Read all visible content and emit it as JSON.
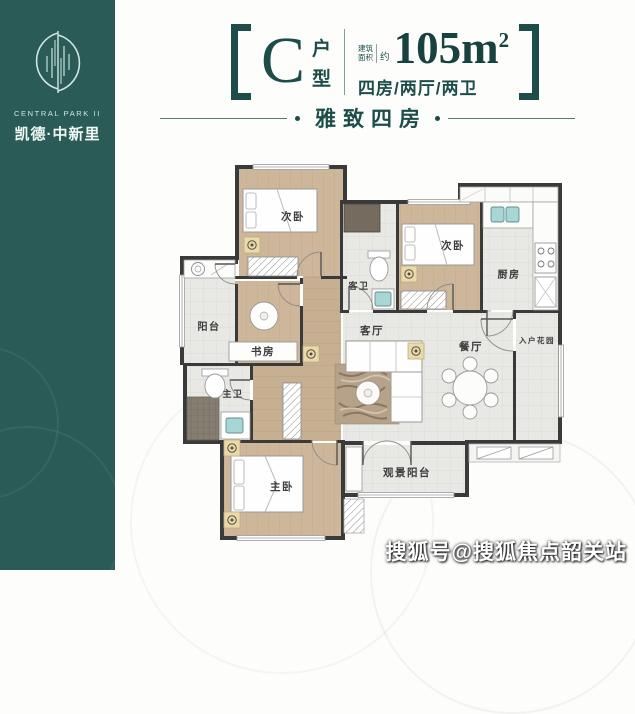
{
  "brand": {
    "name_en": "CENTRAL PARK II",
    "name_cn": "凯德·中新里"
  },
  "header": {
    "type_letter": "C",
    "type_chars": [
      "户",
      "型"
    ],
    "area_prefix_top": "建筑",
    "area_prefix_bottom": "面积",
    "area_approx": "约",
    "area_value": "105m",
    "area_sup": "2",
    "layout_desc": "四房/两厅/两卫",
    "subtitle": "雅致四房"
  },
  "floorplan": {
    "rooms": {
      "bedroom_top_left": "次卧",
      "bedroom_top_right": "次卧",
      "kitchen": "厨房",
      "guest_bath": "客卫",
      "balcony": "阳台",
      "study": "书房",
      "living": "客厅",
      "dining": "餐厅",
      "entry_garden": "入户花园",
      "master_bath": "主卫",
      "master_bedroom": "主卧",
      "view_balcony": "观景阳台"
    }
  },
  "watermark": "搜狐号@搜狐焦点韶关站",
  "colors": {
    "teal_band": "#2a5b57",
    "title_teal": "#1d4d49",
    "wall": "#3a3a3a",
    "wood_floor": "#cdb69a",
    "tile_floor": "#e8e8e5",
    "sink_teal": "#a7d6d4"
  }
}
